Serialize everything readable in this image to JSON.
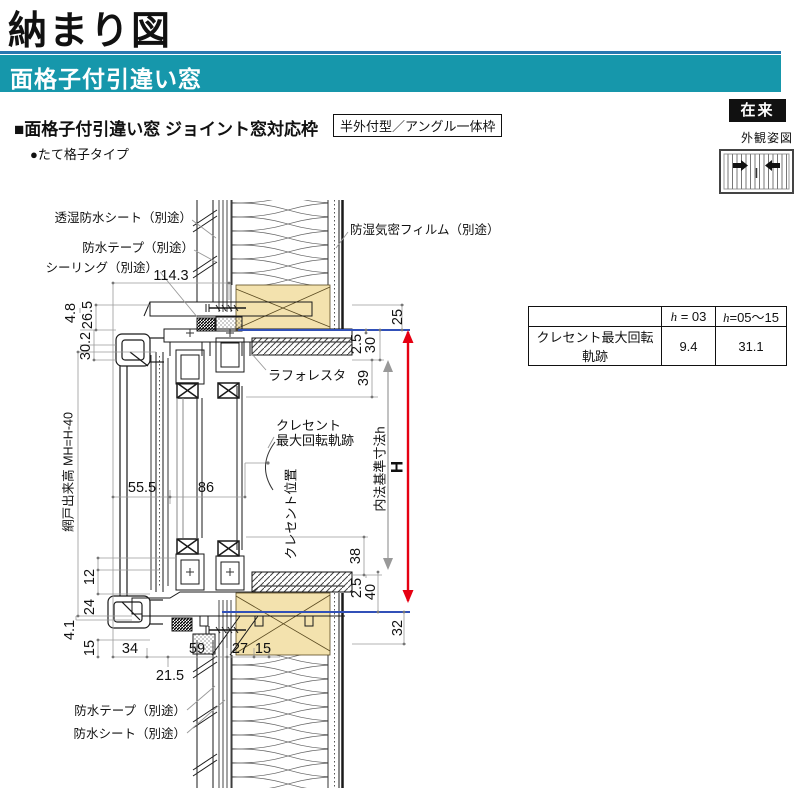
{
  "header": {
    "title": "納まり図",
    "banner": "面格子付引違い窓",
    "badge": "在来",
    "appearance_label": "外観姿図"
  },
  "section": {
    "heading": "■面格子付引違い窓 ジョイント窓対応枠",
    "frame_type": "半外付型／アングル一体枠",
    "grille_type": "●たて格子タイプ"
  },
  "spec_table": {
    "headers": [
      {
        "var": "h",
        "rest": " = 03"
      },
      {
        "var": "h",
        "rest": "=05～15"
      }
    ],
    "row_label": "クレセント最大回転軌跡",
    "values": [
      "9.4",
      "31.1"
    ]
  },
  "callouts": {
    "moisture_sheet": "透湿防水シート（別途）",
    "waterproof_tape_top": "防水テープ（別途）",
    "sealing": "シーリング（別途）",
    "vapor_film": "防湿気密フィルム（別途）",
    "interior_trim": "ラフォレスタ",
    "crescent_line1": "クレセント",
    "crescent_line2": "最大回転軌跡",
    "crescent_position": "クレセント位置",
    "screen_height": "網戸出来高 MH=H-40",
    "inner_dim_label": "内法基準寸法h",
    "overall_height": "H",
    "waterproof_tape_bottom": "防水テープ（別途）",
    "waterproof_sheet_bottom": "防水シート（別途）"
  },
  "dims": {
    "d114_3": "114.3",
    "d55_5": "55.5",
    "d86": "86",
    "d34": "34",
    "d21_5": "21.5",
    "d59": "59",
    "d27": "27",
    "d15": "15",
    "l4_8": "4.8",
    "l26_5": "26.5",
    "l30_2": "30.2",
    "l12": "12",
    "l24": "24",
    "l4_1": "4.1",
    "l15": "15",
    "r25": "25",
    "r2_5_top": "2.5",
    "r30": "30",
    "r39": "39",
    "r38": "38",
    "r2_5_bottom": "2.5",
    "r40": "40",
    "r32": "32"
  },
  "colors": {
    "banner_teal": "#1697ab",
    "accent_blue": "#2878b0",
    "badge_black": "#111111",
    "dimension_red": "#e60012",
    "reference_blue": "#3150b8",
    "wood_tan": "#f3e2ae"
  }
}
